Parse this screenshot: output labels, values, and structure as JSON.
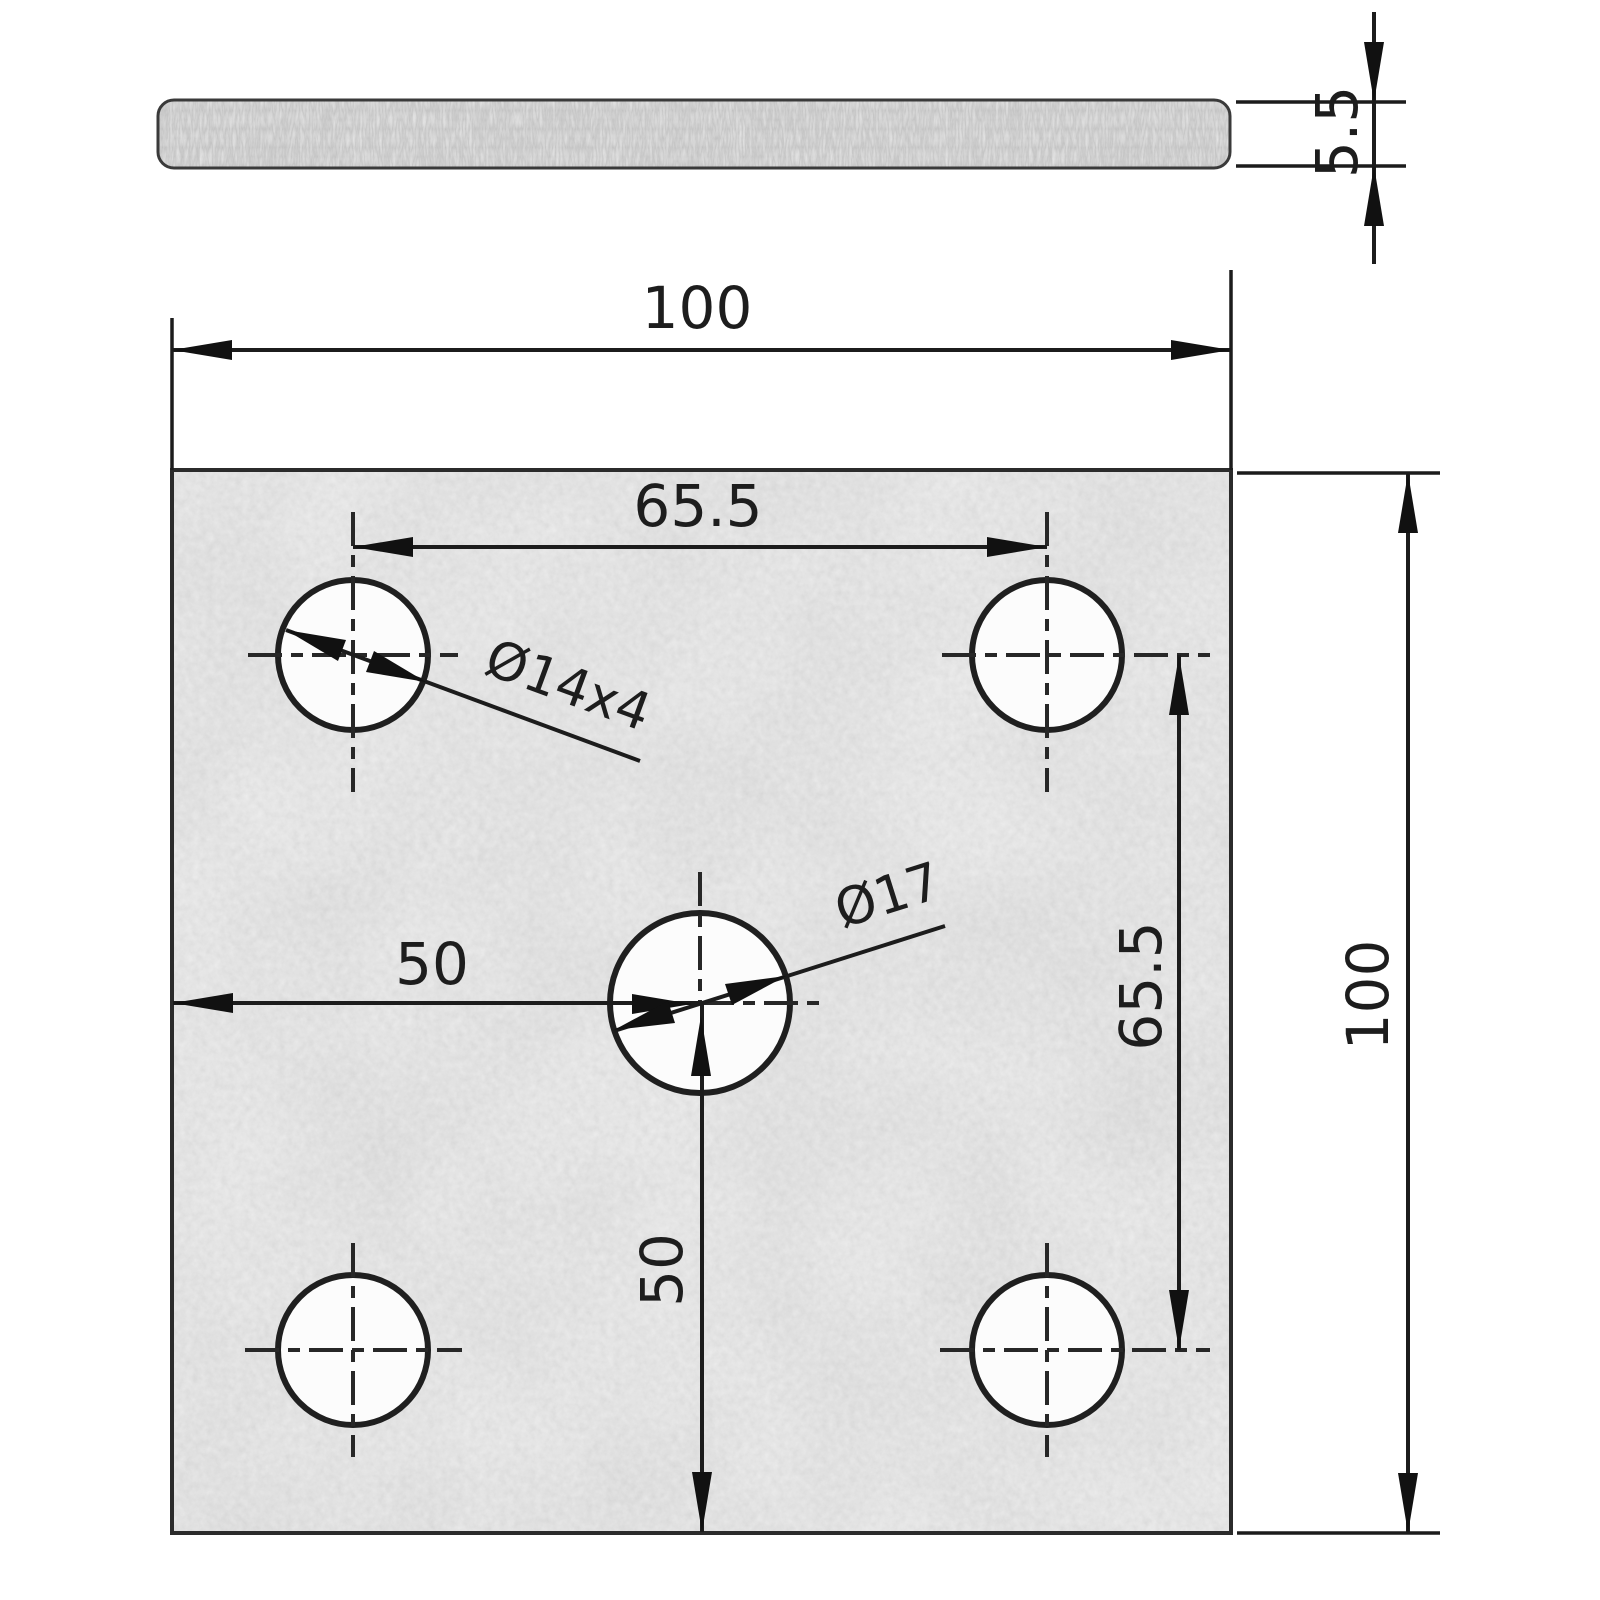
{
  "drawing": {
    "description": "Engineering drawing of a square galvanized flat plate with four corner holes and one center hole, shown in edge view (top) and plan view (bottom)",
    "colors": {
      "line": "#1c1c1c",
      "plate_fill": "#e3e3e3",
      "edge_bar_fill": "#d6d6d6",
      "hole_fill": "#fcfcfc",
      "background": "#ffffff"
    },
    "edge_view": {
      "thickness_dim": "5.5"
    },
    "plan_view": {
      "width_dim": "100",
      "height_dim": "100",
      "hole_span_x_dim": "65.5",
      "hole_span_y_dim": "65.5",
      "center_offset_x_dim": "50",
      "center_offset_y_dim": "50",
      "corner_holes_dim": "Ø14x4",
      "center_hole_dim": "Ø17"
    }
  }
}
